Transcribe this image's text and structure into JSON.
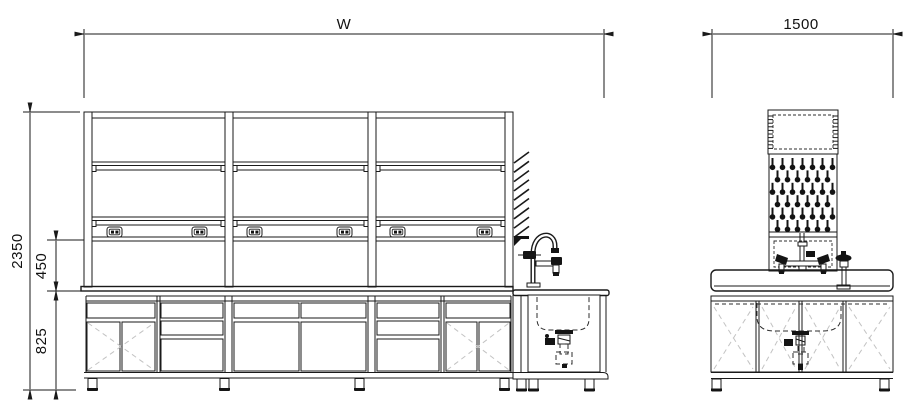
{
  "dimensions": {
    "front_width": "W",
    "side_width": "1500",
    "overall_height": "2350",
    "shelf_to_bench": "450",
    "bench_height": "825"
  },
  "front_view": {
    "bays": 3,
    "shelf_rows_per_bay": 2,
    "outlet_positions": [
      107,
      192,
      247,
      337,
      390,
      477
    ],
    "outlet_y": 227,
    "hatch_marks": 9,
    "modules": [
      "drawer-over-doors",
      "three-drawer-stack",
      "drawers-over-doors",
      "three-drawer-stack",
      "drawer-over-doors",
      "sink-cabinet"
    ]
  },
  "side_view": {
    "pegboard": {
      "rows": 6,
      "cols_odd": 7,
      "cols_even": 6,
      "x_odd": 772.5,
      "x_even": 777.5,
      "y0": 158,
      "row_h": 12.4,
      "col_w": 10
    },
    "scallop_ticks": 10,
    "door_count": 4
  },
  "colors": {
    "line": "#1a1a1a",
    "hidden": "#2e2e2e",
    "swing": "#c3c3c3",
    "background": "#ffffff"
  },
  "icons": {
    "power_outlet": "power-outlet-icon",
    "peg": "drip-peg-icon",
    "faucet": "gooseneck-faucet-icon"
  }
}
